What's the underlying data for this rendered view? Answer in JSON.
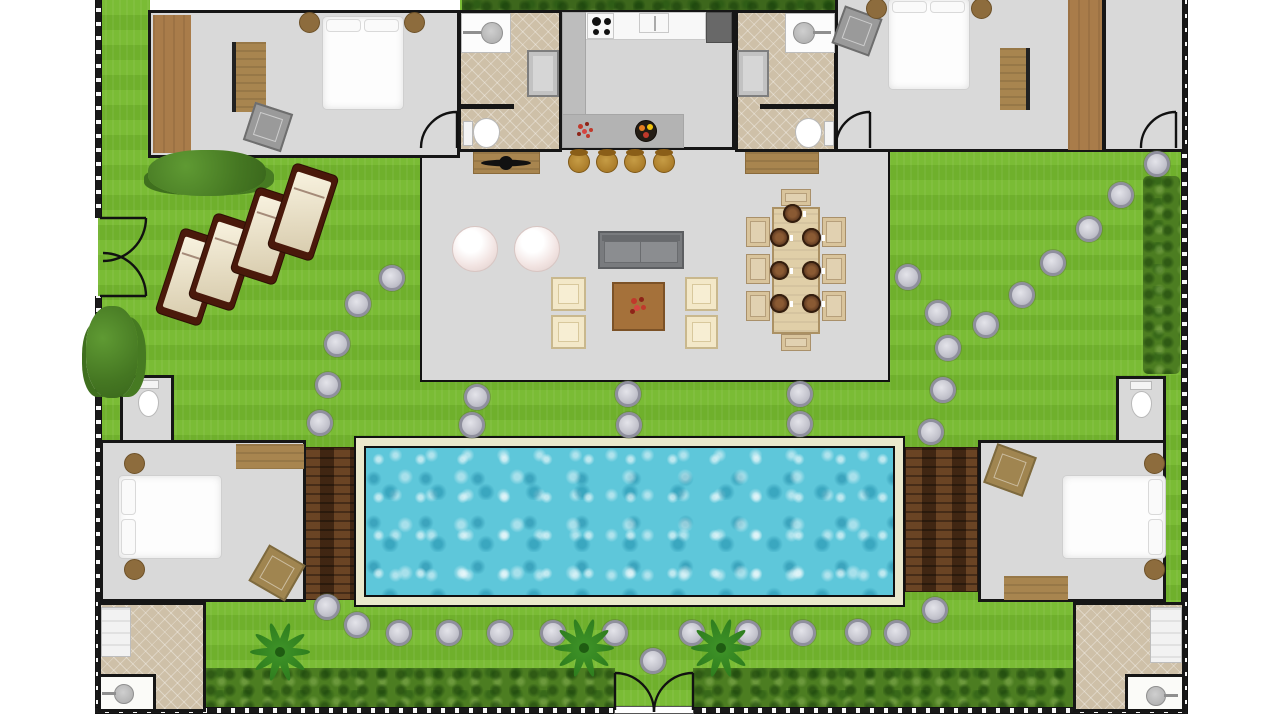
{
  "scene": {
    "canvas": {
      "width": 1280,
      "height": 720
    },
    "palette": {
      "grass1": "#7abc35",
      "grass2": "#6fb02c",
      "hedge": "#4c7d21",
      "hedgedark": "#3d671c",
      "floor": "#d9d9d9",
      "tile": "#cec0a8",
      "wall": "#161616",
      "wood1": "#a97c4a",
      "wood2": "#a8854f",
      "deck": "#4e3018",
      "poolframe": "#eae8cc",
      "water": "#5ec7da",
      "stone": "#c6c6cf",
      "stonering": "#8f8f9d",
      "loungerframe": "#4a190b",
      "cream": "#f3e8c8",
      "barwood": "#a0701f",
      "counter": "#bdbdbd",
      "fridge": "#686868",
      "tablewood": "#e0cfa8",
      "chairwood": "#d9c49c",
      "plate": "#53311c",
      "bed": "#fdfdfd",
      "nightstand": "#8d6c3d",
      "ottogray": "#9a9a9a",
      "ottowood": "#a5713a",
      "ottowood2": "#a08550"
    },
    "stones": [
      [
        392,
        278
      ],
      [
        358,
        304
      ],
      [
        337,
        344
      ],
      [
        328,
        385
      ],
      [
        320,
        423
      ],
      [
        477,
        397
      ],
      [
        472,
        425
      ],
      [
        628,
        394
      ],
      [
        629,
        425
      ],
      [
        800,
        394
      ],
      [
        800,
        424
      ],
      [
        908,
        277
      ],
      [
        938,
        313
      ],
      [
        948,
        348
      ],
      [
        943,
        390
      ],
      [
        931,
        432
      ],
      [
        986,
        325
      ],
      [
        1022,
        295
      ],
      [
        1053,
        263
      ],
      [
        1089,
        229
      ],
      [
        1121,
        195
      ],
      [
        1157,
        164
      ],
      [
        935,
        610
      ],
      [
        327,
        607
      ],
      [
        357,
        625
      ],
      [
        399,
        633
      ],
      [
        449,
        633
      ],
      [
        500,
        633
      ],
      [
        553,
        633
      ],
      [
        615,
        633
      ],
      [
        653,
        661
      ],
      [
        692,
        633
      ],
      [
        748,
        633
      ],
      [
        803,
        633
      ],
      [
        858,
        632
      ],
      [
        897,
        633
      ]
    ],
    "loungers": [
      {
        "x": 191,
        "y": 277,
        "rot": 18
      },
      {
        "x": 224,
        "y": 262,
        "rot": 18
      },
      {
        "x": 266,
        "y": 236,
        "rot": 18
      },
      {
        "x": 303,
        "y": 212,
        "rot": 18
      }
    ],
    "barstools": [
      {
        "x": 579,
        "y": 162
      },
      {
        "x": 607,
        "y": 162
      },
      {
        "x": 635,
        "y": 162
      },
      {
        "x": 664,
        "y": 162
      }
    ],
    "beanbags": [
      {
        "x": 475,
        "y": 249
      },
      {
        "x": 537,
        "y": 249
      }
    ],
    "armchairs": [
      {
        "x": 551,
        "y": 277,
        "w": 35,
        "h": 34
      },
      {
        "x": 551,
        "y": 315,
        "w": 35,
        "h": 34
      },
      {
        "x": 685,
        "y": 277,
        "w": 33,
        "h": 34
      },
      {
        "x": 685,
        "y": 315,
        "w": 33,
        "h": 34
      }
    ],
    "dining_chairs": [
      {
        "x": 781,
        "y": 189,
        "w": 30,
        "h": 17
      },
      {
        "x": 781,
        "y": 334,
        "w": 30,
        "h": 17
      },
      {
        "x": 746,
        "y": 217,
        "w": 24,
        "h": 30
      },
      {
        "x": 746,
        "y": 254,
        "w": 24,
        "h": 30
      },
      {
        "x": 746,
        "y": 291,
        "w": 24,
        "h": 30
      },
      {
        "x": 822,
        "y": 217,
        "w": 24,
        "h": 30
      },
      {
        "x": 822,
        "y": 254,
        "w": 24,
        "h": 30
      },
      {
        "x": 822,
        "y": 291,
        "w": 24,
        "h": 30
      }
    ],
    "plates": [
      [
        792,
        213
      ],
      [
        779,
        237
      ],
      [
        811,
        237
      ],
      [
        779,
        270
      ],
      [
        811,
        270
      ],
      [
        779,
        303
      ],
      [
        811,
        303
      ]
    ],
    "palms": [
      [
        280,
        652
      ],
      [
        584,
        648
      ],
      [
        721,
        648
      ]
    ],
    "bushes": [
      {
        "x": 148,
        "y": 150,
        "w": 118,
        "h": 46
      },
      {
        "x": 86,
        "y": 306,
        "w": 52,
        "h": 92
      }
    ]
  }
}
